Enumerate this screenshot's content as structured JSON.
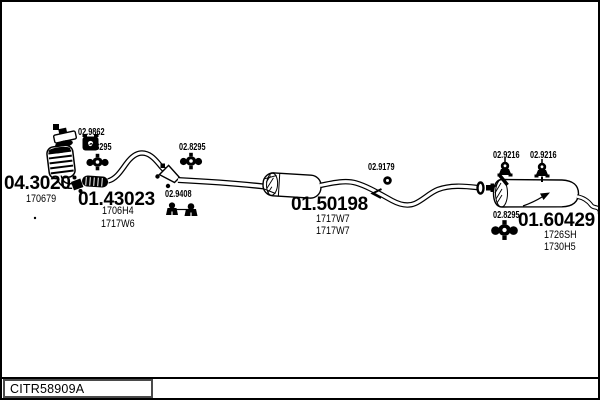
{
  "colors": {
    "ink": "#000000",
    "paper": "#ffffff",
    "footer_box_border": "#4a4a4a"
  },
  "footer": {
    "code": "CITR58909A"
  },
  "parts": {
    "front_pipe": {
      "number": "04.3020",
      "refs": [
        "170679"
      ]
    },
    "center_pipe": {
      "number": "01.43023",
      "refs": [
        "1706H4",
        "1717W6"
      ]
    },
    "middle_silencer": {
      "number": "01.50198",
      "refs": [
        "1717W7",
        "1717W7"
      ]
    },
    "rear_silencer": {
      "number": "01.60429",
      "refs": [
        "1726SH",
        "1730H5"
      ]
    },
    "fittings": [
      {
        "number": "02.9862",
        "icon": "gasket-icon"
      },
      {
        "number": "02.8295",
        "icon": "clamp-icon"
      },
      {
        "number": "02.8295",
        "icon": "clamp-icon"
      },
      {
        "number": "02.9408",
        "icon": "rubber-mount-icon"
      },
      {
        "number": "02.9179",
        "icon": "ring-gasket-icon"
      },
      {
        "number": "02.9216",
        "icon": "rubber-hanger-icon"
      },
      {
        "number": "02.9216",
        "icon": "rubber-hanger-icon"
      },
      {
        "number": "02.8295",
        "icon": "clamp-icon"
      }
    ]
  }
}
